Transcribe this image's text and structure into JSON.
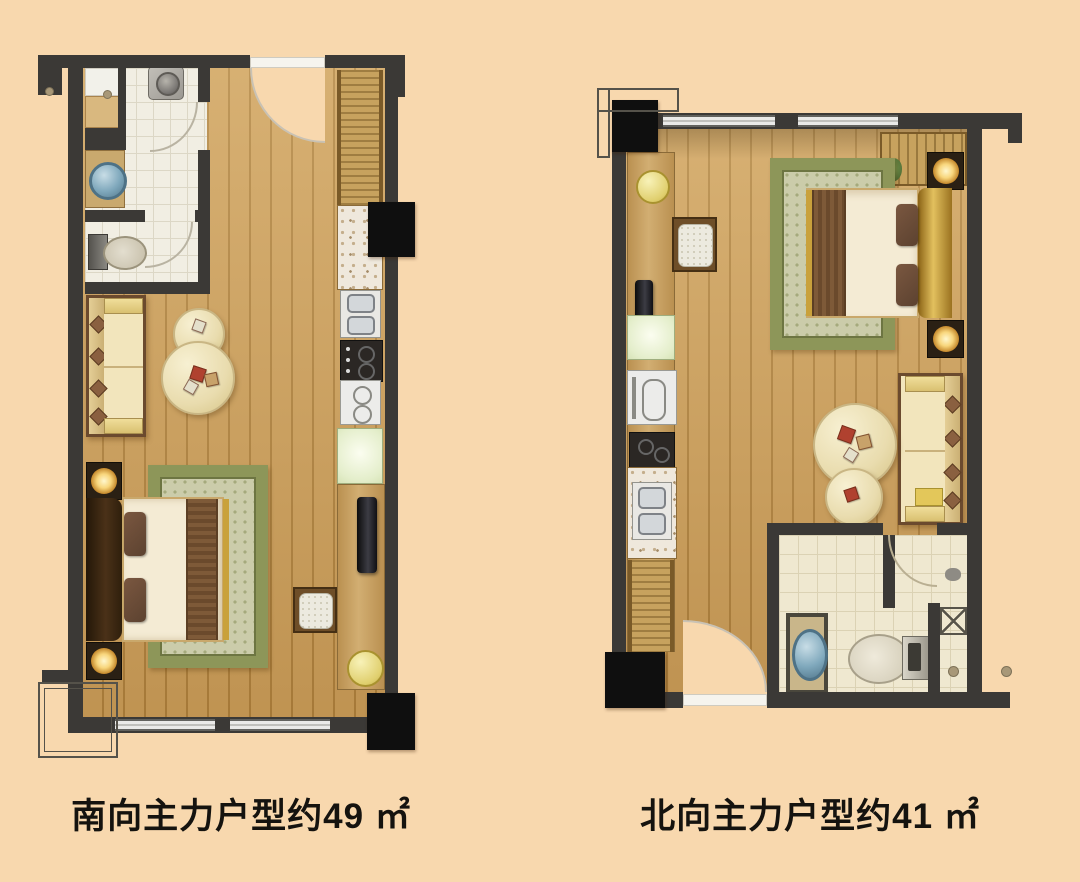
{
  "page": {
    "background_color": "#F8D8AE"
  },
  "plans": [
    {
      "id": "south-unit",
      "caption": "南向主力户型约49 ㎡",
      "unit_name": "南向主力户型",
      "area_approx_sqm": 49,
      "area_unit": "㎡"
    },
    {
      "id": "north-unit",
      "caption": "北向主力户型约41 ㎡",
      "unit_name": "北向主力户型",
      "area_approx_sqm": 41,
      "area_unit": "㎡"
    }
  ],
  "palette": {
    "background": "#F8D8AE",
    "wall": "#3B3936",
    "column": "#0F0F0F",
    "wood_floor": "#CDA05C",
    "wood_plank_line": "#AE813E",
    "bath_tile_south": "#F1EEE3",
    "bath_tile_north": "#EFE8D0",
    "rug_border_green": "#8D9659",
    "rug_field": "#CBCCAA",
    "sofa_cream": "#F2E5BC",
    "bed_duvet": "#F4EBD4",
    "bed_runner_brown": "#7C5836",
    "headboard_gold": "#D4AE4E",
    "lamp_glow": "#F8D67C",
    "basin_blue": "#7FA8BC",
    "caption_text": "#15130F"
  }
}
